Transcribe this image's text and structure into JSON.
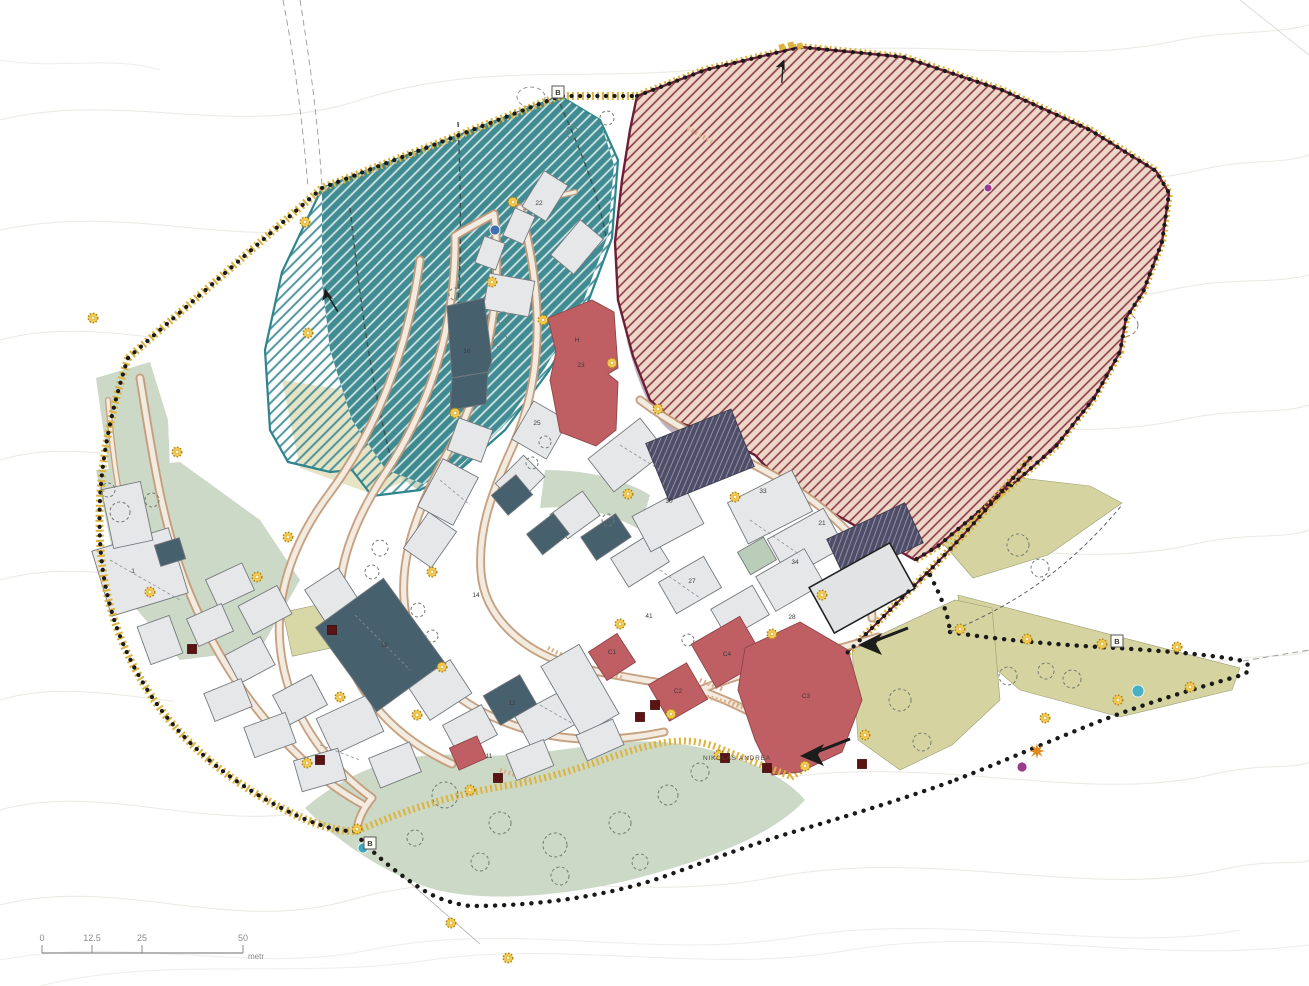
{
  "map": {
    "title": "village-site-plan",
    "scale_bar": {
      "unit": "metr",
      "ticks": [
        {
          "label": "0",
          "x": 42
        },
        {
          "label": "12.5",
          "x": 92
        },
        {
          "label": "25",
          "x": 142
        },
        {
          "label": "50",
          "x": 243
        }
      ],
      "y": 953
    },
    "text_labels": [
      {
        "text": "NIKOLAS ANDREA",
        "x": 737,
        "y": 760
      }
    ],
    "zone_markers": [
      {
        "letter": "B",
        "x": 558,
        "y": 92
      },
      {
        "letter": "B",
        "x": 1117,
        "y": 641
      },
      {
        "letter": "B",
        "x": 370,
        "y": 843
      }
    ],
    "building_labels": [
      {
        "text": "22",
        "x": 539,
        "y": 205
      },
      {
        "text": "16",
        "x": 467,
        "y": 353
      },
      {
        "text": "H",
        "x": 577,
        "y": 342
      },
      {
        "text": "23",
        "x": 581,
        "y": 367
      },
      {
        "text": "25",
        "x": 537,
        "y": 425
      },
      {
        "text": "30",
        "x": 669,
        "y": 503
      },
      {
        "text": "27",
        "x": 692,
        "y": 583
      },
      {
        "text": "41",
        "x": 649,
        "y": 618
      },
      {
        "text": "21",
        "x": 822,
        "y": 525
      },
      {
        "text": "33",
        "x": 763,
        "y": 493
      },
      {
        "text": "34",
        "x": 795,
        "y": 564
      },
      {
        "text": "28",
        "x": 792,
        "y": 619
      },
      {
        "text": "1",
        "x": 133,
        "y": 573
      },
      {
        "text": "13",
        "x": 384,
        "y": 647
      },
      {
        "text": "12",
        "x": 512,
        "y": 705
      },
      {
        "text": "14",
        "x": 476,
        "y": 597
      },
      {
        "text": "11",
        "x": 489,
        "y": 758
      },
      {
        "text": "C1",
        "x": 612,
        "y": 654
      },
      {
        "text": "C2",
        "x": 678,
        "y": 693
      },
      {
        "text": "C4",
        "x": 727,
        "y": 656
      },
      {
        "text": "C3",
        "x": 806,
        "y": 698
      }
    ],
    "streetlights": [
      [
        93,
        318
      ],
      [
        177,
        452
      ],
      [
        305,
        222
      ],
      [
        308,
        333
      ],
      [
        513,
        202
      ],
      [
        492,
        282
      ],
      [
        543,
        320
      ],
      [
        612,
        363
      ],
      [
        455,
        413
      ],
      [
        288,
        537
      ],
      [
        257,
        577
      ],
      [
        150,
        592
      ],
      [
        432,
        572
      ],
      [
        340,
        697
      ],
      [
        442,
        667
      ],
      [
        417,
        715
      ],
      [
        470,
        790
      ],
      [
        307,
        763
      ],
      [
        357,
        829
      ],
      [
        451,
        923
      ],
      [
        508,
        958
      ],
      [
        620,
        624
      ],
      [
        671,
        714
      ],
      [
        719,
        755
      ],
      [
        772,
        634
      ],
      [
        805,
        766
      ],
      [
        865,
        735
      ],
      [
        822,
        595
      ],
      [
        960,
        629
      ],
      [
        1027,
        639
      ],
      [
        1102,
        644
      ],
      [
        1177,
        647
      ],
      [
        1190,
        687
      ],
      [
        1118,
        700
      ],
      [
        1045,
        718
      ],
      [
        658,
        409
      ],
      [
        735,
        497
      ],
      [
        628,
        494
      ]
    ],
    "wall_squares": [
      [
        332,
        630
      ],
      [
        320,
        760
      ],
      [
        498,
        778
      ],
      [
        192,
        649
      ],
      [
        655,
        705
      ],
      [
        640,
        717
      ],
      [
        725,
        758
      ],
      [
        767,
        768
      ],
      [
        862,
        764
      ]
    ],
    "poi_dots": [
      {
        "x": 495,
        "y": 230,
        "r": 5,
        "color": "#3f6fae",
        "name": "blue-dot"
      },
      {
        "x": 363,
        "y": 848,
        "r": 5,
        "color": "#3aa9bd",
        "name": "teal-dot"
      },
      {
        "x": 1138,
        "y": 691,
        "r": 6,
        "color": "#49b0c4",
        "name": "cyan-dot"
      },
      {
        "x": 988,
        "y": 188,
        "r": 4,
        "color": "#993d8a",
        "name": "purple-dot"
      },
      {
        "x": 1022,
        "y": 767,
        "r": 5,
        "color": "#993d8a",
        "name": "purple-dot"
      }
    ],
    "star": {
      "x": 1037,
      "y": 751,
      "color": "#e08a1e"
    },
    "arrows": [
      {
        "x": 858,
        "y": 641,
        "angle": 0,
        "scale": 1.0
      },
      {
        "x": 800,
        "y": 752,
        "angle": 0,
        "scale": 1.0
      },
      {
        "x": 786,
        "y": 60,
        "angle": 115,
        "scale": 0.45
      },
      {
        "x": 327,
        "y": 288,
        "angle": 80,
        "scale": 0.5
      }
    ],
    "trees": [
      [
        445,
        795,
        13
      ],
      [
        500,
        823,
        11
      ],
      [
        555,
        845,
        12
      ],
      [
        620,
        823,
        11
      ],
      [
        668,
        795,
        10
      ],
      [
        480,
        862,
        9
      ],
      [
        560,
        876,
        9
      ],
      [
        700,
        772,
        9
      ],
      [
        415,
        838,
        8
      ],
      [
        640,
        862,
        8
      ],
      [
        1008,
        676,
        9
      ],
      [
        1046,
        671,
        8
      ],
      [
        1072,
        679,
        9
      ],
      [
        1018,
        545,
        11
      ],
      [
        1040,
        568,
        9
      ],
      [
        900,
        700,
        11
      ],
      [
        922,
        742,
        9
      ],
      [
        120,
        512,
        10
      ],
      [
        108,
        490,
        7
      ],
      [
        152,
        500,
        7
      ],
      [
        455,
        294,
        6
      ],
      [
        503,
        318,
        6
      ],
      [
        500,
        340,
        7
      ],
      [
        380,
        548,
        8
      ],
      [
        372,
        572,
        7
      ],
      [
        545,
        442,
        6
      ],
      [
        532,
        463,
        6
      ],
      [
        608,
        520,
        6
      ],
      [
        688,
        640,
        6
      ],
      [
        418,
        610,
        7
      ],
      [
        432,
        636,
        6
      ],
      [
        607,
        118,
        7
      ],
      [
        572,
        132,
        6
      ]
    ],
    "colors": {
      "castle_fill": "#eed7c6",
      "castle_hatch": "#8a3b4b",
      "castle_wall": "#6d1f37",
      "wall_gold": "#ddb33d",
      "boundary_dot": "#1a1a1a",
      "teal": "#37868d",
      "sage": "#ccd9c7",
      "olive": "#d5d4a0",
      "street": "#c49c7c",
      "building_gray": "#e6e7e9",
      "building_slate": "#46606e",
      "building_red": "#bf5f63",
      "rock_overlay": "#a593a5",
      "ruin_red": "#c2495d",
      "light_gold": "#f2c94c",
      "marker_square": "#5a1414"
    }
  }
}
